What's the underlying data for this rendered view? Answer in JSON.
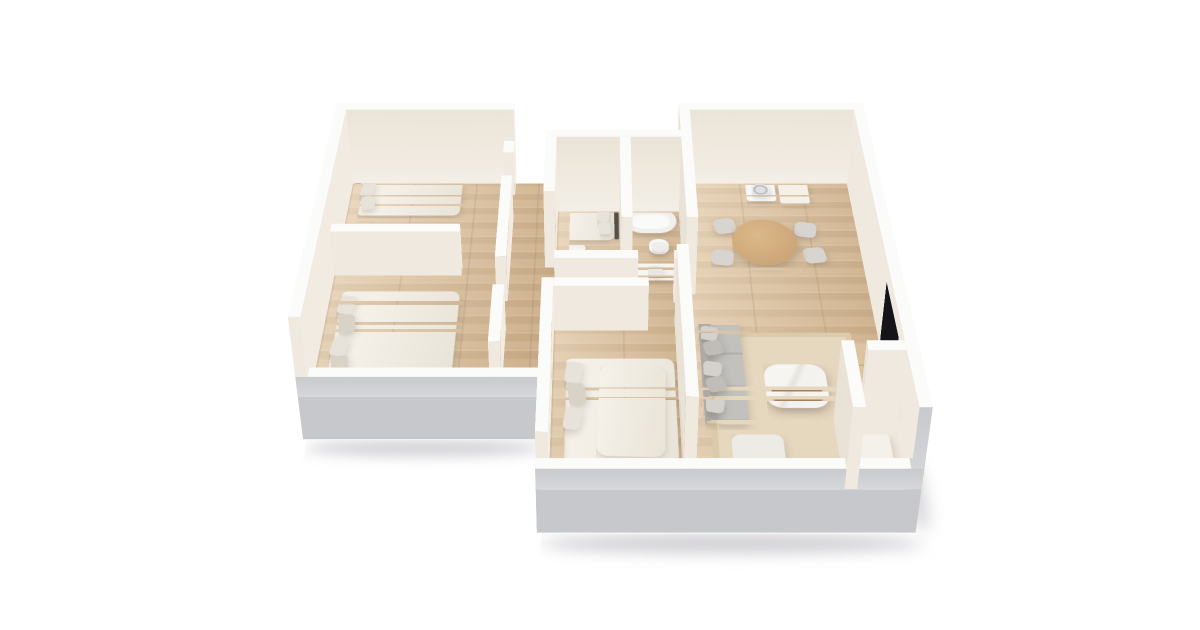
{
  "canvas": {
    "width": 1200,
    "height": 630,
    "background": "#ffffff"
  },
  "scene": {
    "type": "3d-floorplan-render",
    "description": "Perspective 3D floor plan of an apartment with white walls and oak wood floors on a white background"
  },
  "palette": {
    "wallTop": "#fbfbfa",
    "wallInner": "#efe9df",
    "wallNorth": "#f6f2ea",
    "wallEast": "#f2ece2",
    "wallWest": "#e9e2d6",
    "backWallFace": "linear-gradient(to top,#ebe4d8,#f4efe7)",
    "frontGray": "linear-gradient(to top,#c9cacd,#d7d8db)",
    "slabGray": "#c7c8cc",
    "outerWhite": "#f3f3f5",
    "floorBase": "#d7bb97",
    "floorAlt": "#cbae88",
    "rug": "#e6d7bf",
    "nookFloor": "#efe9dd",
    "sofa": "#c3c1bd",
    "sofaBack": "#adaba7",
    "cushionA": "#d5d2cd",
    "cushionB": "#c0bdb8",
    "duvet": "linear-gradient(100deg,#f4f0e8 30%,#e9e4d8)",
    "pillow": "#e8e3da",
    "headboard": "#55504a",
    "woodLight": "#dfcfae",
    "woodMid": "#cfa97c",
    "woodDark": "#a87e5b",
    "chair": "#d8d5d1",
    "white": "#f6f4ef",
    "marble": "linear-gradient(115deg,#f7f5f1 38%,#e6e3dd 45%,#f4f2ee 52%,#f7f5f1)",
    "tv": "#141419",
    "basin": "#e9e7e3",
    "shadow": "rgba(120,118,128,0.34)"
  },
  "rooms": [
    {
      "name": "bedroom-top-left",
      "furniture": [
        "single-bed",
        "pillows",
        "nightstand"
      ]
    },
    {
      "name": "bedroom-bottom-left",
      "furniture": [
        "double-bed",
        "pillows"
      ]
    },
    {
      "name": "bedroom-center",
      "furniture": [
        "bed",
        "pillows",
        "foot-bench"
      ]
    },
    {
      "name": "bathroom",
      "furniture": [
        "bathtub",
        "toilet",
        "vanity-sink"
      ]
    },
    {
      "name": "laundry-dining",
      "furniture": [
        "washing-machine",
        "cabinet",
        "round-dining-table",
        "four-chairs"
      ]
    },
    {
      "name": "bedroom-bottom-center",
      "furniture": [
        "double-bed",
        "pillows",
        "throw-duvet"
      ]
    },
    {
      "name": "living-room",
      "furniture": [
        "sectional-sofa",
        "sofa-pillows",
        "coffee-table",
        "rug",
        "ottoman",
        "tv",
        "media-console"
      ]
    },
    {
      "name": "entry-nook",
      "furniture": [
        "bench"
      ]
    }
  ]
}
